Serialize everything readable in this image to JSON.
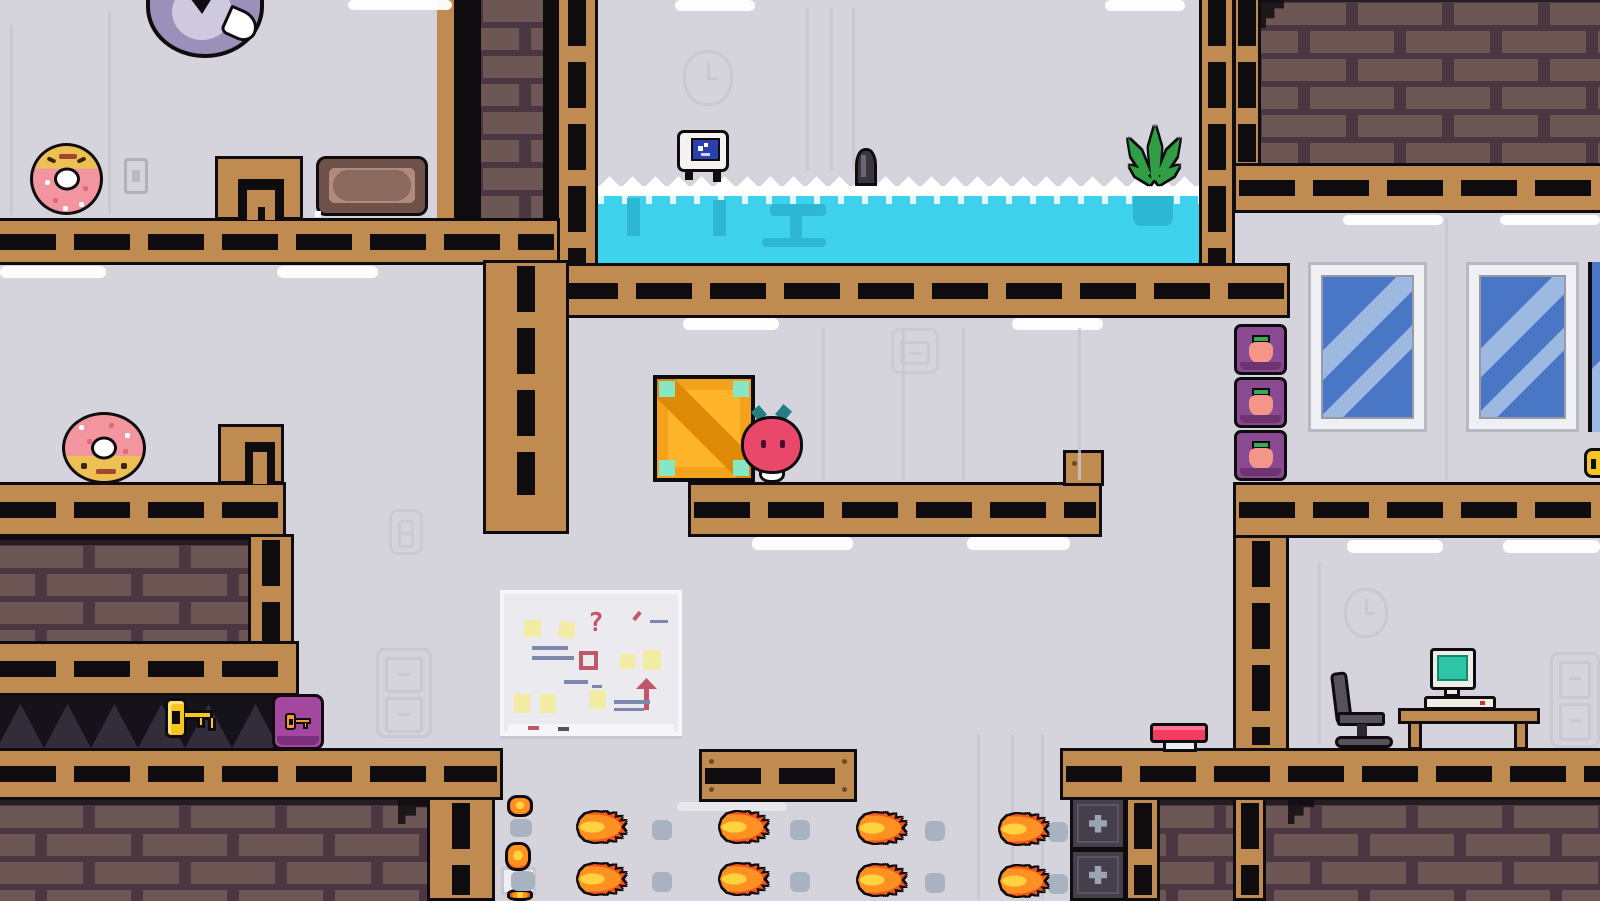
{
  "scene": {
    "width": 1600,
    "height": 901,
    "description": "pixel-art office platformer level"
  },
  "palette": {
    "wall": "#d5d4dc",
    "wall_seam": "#c6c5cf",
    "ghost": "#c3c2cc",
    "outline": "#0f0c10",
    "wood": "#bf8b51",
    "brick_bg": "#4a3741",
    "brick": "#6d5755",
    "water": "#3ed2ec",
    "silhouette": "#2db7d2",
    "foam": "#ffffff",
    "crate_orange": "#f4a11c",
    "crate_panel": "#ffb42a",
    "crate_stripe": "#df8a07",
    "crate_corner": "#86e7c6",
    "radish_body": "#e9486b",
    "leaf_teal": "#237f83",
    "plant_green": "#2f9e44",
    "donut_pink": "#f2959e",
    "donut_dough": "#ecc052",
    "purple_block": "#8a4a92",
    "purple_dark": "#6e3470",
    "leaf_green": "#3aa854",
    "peach": "#f4958a",
    "lock_purple": "#a4479f",
    "key_gold": "#f5c61e",
    "key_icon": "#f29d2e",
    "fire_core": "#ffd23e",
    "fire_mid": "#ff9022",
    "fire_outer": "#f4551b",
    "smoke": "#a9b2c1",
    "metal": "#453f4b",
    "metal_light": "#9aa3b1",
    "button_red": "#f43b60",
    "button_base": "#e8edf4",
    "window_glass": "#4a77c5",
    "window_stripe": "#9db9e2",
    "frame_white": "#eef0f4",
    "spike": "#312d3b",
    "pit": "#15121a",
    "bird": "#9b90ba",
    "bird_light": "#cfc9e0",
    "chair": "#56515b",
    "screen_teal": "#2cc6a4",
    "screen_blue": "#2b3fae",
    "light": "#ffffff"
  },
  "whiteboard": {
    "symbol": "?"
  },
  "sprites": {
    "bird": {
      "x": 146,
      "y": -16,
      "w": 118,
      "h": 74,
      "label": "purple bird peeking from top"
    },
    "donut1": {
      "x": 30,
      "y": 143,
      "w": 73,
      "h": 72,
      "label": "upside-down donut collectible"
    },
    "donut2": {
      "x": 62,
      "y": 412,
      "w": 84,
      "h": 72,
      "label": "donut collectible with face"
    },
    "light_switch": {
      "x": 124,
      "y": 158,
      "w": 24,
      "h": 36,
      "label": "wall light switch"
    },
    "couch": {
      "x": 316,
      "y": 156,
      "w": 112,
      "h": 60,
      "label": "brown bench cushion"
    },
    "vent1": {
      "x": 215,
      "y": 156,
      "w": 88,
      "h": 64,
      "label": "wooden vent structure"
    },
    "vent2": {
      "x": 218,
      "y": 424,
      "w": 66,
      "h": 60,
      "label": "wooden vent structure"
    },
    "wall_clock_top": {
      "x": 683,
      "y": 50,
      "w": 50,
      "h": 56,
      "label": "faint wall clock"
    },
    "wall_clock_right": {
      "x": 1344,
      "y": 588,
      "w": 44,
      "h": 50,
      "label": "faint wall clock"
    },
    "cabinet_left": {
      "x": 376,
      "y": 648,
      "w": 56,
      "h": 90,
      "label": "file cabinet outline"
    },
    "cabinet_right": {
      "x": 1550,
      "y": 652,
      "w": 50,
      "h": 96,
      "label": "file cabinet outline"
    },
    "cabinet_mid": {
      "x": 891,
      "y": 328,
      "w": 48,
      "h": 46,
      "label": "faint wall frame"
    },
    "cabinet_small": {
      "x": 389,
      "y": 509,
      "w": 34,
      "h": 46,
      "label": "faint wall frame"
    },
    "whiteboard": {
      "x": 500,
      "y": 590,
      "w": 182,
      "h": 146,
      "label": "whiteboard with sticky notes"
    },
    "monitor_buddy": {
      "x": 677,
      "y": 130,
      "w": 52,
      "h": 50,
      "label": "computer monitor floating on water"
    },
    "periscope": {
      "x": 855,
      "y": 148,
      "w": 22,
      "h": 38,
      "label": "small dark object at waterline"
    },
    "plant": {
      "x": 1128,
      "y": 126,
      "w": 52,
      "h": 66,
      "label": "green plant in flooded room"
    },
    "key_gold": {
      "x": 165,
      "y": 694,
      "w": 52,
      "h": 50,
      "label": "golden key over spikes"
    },
    "lock_block": {
      "x": 272,
      "y": 694,
      "w": 52,
      "h": 56,
      "label": "purple key-lock block"
    },
    "crate": {
      "x": 653,
      "y": 375,
      "w": 102,
      "h": 107,
      "label": "orange shipping crate"
    },
    "radish_hero": {
      "x": 741,
      "y": 414,
      "w": 62,
      "h": 71,
      "label": "radish player character"
    },
    "red_button": {
      "x": 1150,
      "y": 723,
      "w": 58,
      "h": 29,
      "label": "red floor button"
    },
    "office_chair": {
      "x": 1333,
      "y": 672,
      "w": 62,
      "h": 78,
      "label": "office chair"
    },
    "desk": {
      "x": 1398,
      "y": 708,
      "w": 142,
      "h": 42,
      "label": "wooden desk"
    },
    "desk_computer": {
      "x": 1424,
      "y": 648,
      "w": 72,
      "h": 64,
      "label": "retro computer on desk"
    },
    "edge_key": {
      "x": 1584,
      "y": 448,
      "w": 16,
      "h": 30,
      "label": "key at screen edge"
    },
    "white_box": {
      "x": 501,
      "y": 867,
      "w": 35,
      "h": 28,
      "label": "white wall box"
    }
  },
  "repeat": {
    "lights": [
      {
        "x": 348,
        "y": 0,
        "w": 104,
        "h": 10
      },
      {
        "x": 675,
        "y": 0,
        "w": 80,
        "h": 11
      },
      {
        "x": 1105,
        "y": 0,
        "w": 80,
        "h": 11
      },
      {
        "x": 0,
        "y": 266,
        "w": 106,
        "h": 12
      },
      {
        "x": 277,
        "y": 266,
        "w": 101,
        "h": 12
      },
      {
        "x": 683,
        "y": 318,
        "w": 96,
        "h": 12
      },
      {
        "x": 1012,
        "y": 318,
        "w": 91,
        "h": 12
      },
      {
        "x": 752,
        "y": 537,
        "w": 101,
        "h": 13
      },
      {
        "x": 967,
        "y": 537,
        "w": 103,
        "h": 13
      },
      {
        "x": 1347,
        "y": 540,
        "w": 96,
        "h": 13
      },
      {
        "x": 1503,
        "y": 540,
        "w": 97,
        "h": 13
      },
      {
        "x": 1343,
        "y": 215,
        "w": 100,
        "h": 10
      },
      {
        "x": 1500,
        "y": 215,
        "w": 100,
        "h": 10
      },
      {
        "x": 677,
        "y": 802,
        "w": 110,
        "h": 9,
        "dim": true
      }
    ],
    "seams": [
      {
        "x": 10,
        "y": 25,
        "h": 190
      },
      {
        "x": 108,
        "y": 10,
        "h": 203
      },
      {
        "x": 806,
        "y": 8,
        "h": 162
      },
      {
        "x": 830,
        "y": 8,
        "h": 162
      },
      {
        "x": 852,
        "y": 8,
        "h": 162
      },
      {
        "x": 822,
        "y": 328,
        "h": 152
      },
      {
        "x": 902,
        "y": 328,
        "h": 152
      },
      {
        "x": 962,
        "y": 328,
        "h": 152
      },
      {
        "x": 1078,
        "y": 328,
        "h": 152
      },
      {
        "x": 1445,
        "y": 218,
        "h": 262
      },
      {
        "x": 1318,
        "y": 562,
        "h": 182
      },
      {
        "x": 977,
        "y": 735,
        "h": 164
      },
      {
        "x": 1011,
        "y": 735,
        "h": 164
      },
      {
        "x": 1041,
        "y": 735,
        "h": 164
      }
    ],
    "radish_blocks": [
      {
        "x": 1234,
        "y": 324,
        "w": 53,
        "h": 51
      },
      {
        "x": 1234,
        "y": 377,
        "w": 53,
        "h": 51
      },
      {
        "x": 1234,
        "y": 430,
        "w": 53,
        "h": 51
      }
    ],
    "fireballs": [
      {
        "x": 578,
        "y": 812
      },
      {
        "x": 720,
        "y": 812
      },
      {
        "x": 858,
        "y": 813
      },
      {
        "x": 1000,
        "y": 814
      },
      {
        "x": 578,
        "y": 864
      },
      {
        "x": 720,
        "y": 864
      },
      {
        "x": 858,
        "y": 865
      },
      {
        "x": 1000,
        "y": 866
      }
    ],
    "smoke_puffs": [
      {
        "x": 652,
        "y": 820
      },
      {
        "x": 790,
        "y": 820
      },
      {
        "x": 925,
        "y": 821
      },
      {
        "x": 1048,
        "y": 822
      },
      {
        "x": 652,
        "y": 872
      },
      {
        "x": 790,
        "y": 872
      },
      {
        "x": 925,
        "y": 873
      },
      {
        "x": 1048,
        "y": 874
      }
    ],
    "fire_pellets": [
      {
        "x": 507,
        "y": 795,
        "w": 26,
        "h": 22
      },
      {
        "x": 505,
        "y": 842,
        "w": 26,
        "h": 29
      },
      {
        "x": 507,
        "y": 889,
        "w": 26,
        "h": 12
      }
    ],
    "jet_puffs": [
      {
        "x": 510,
        "y": 819,
        "w": 22,
        "h": 18
      },
      {
        "x": 511,
        "y": 871,
        "w": 24,
        "h": 20
      }
    ]
  }
}
